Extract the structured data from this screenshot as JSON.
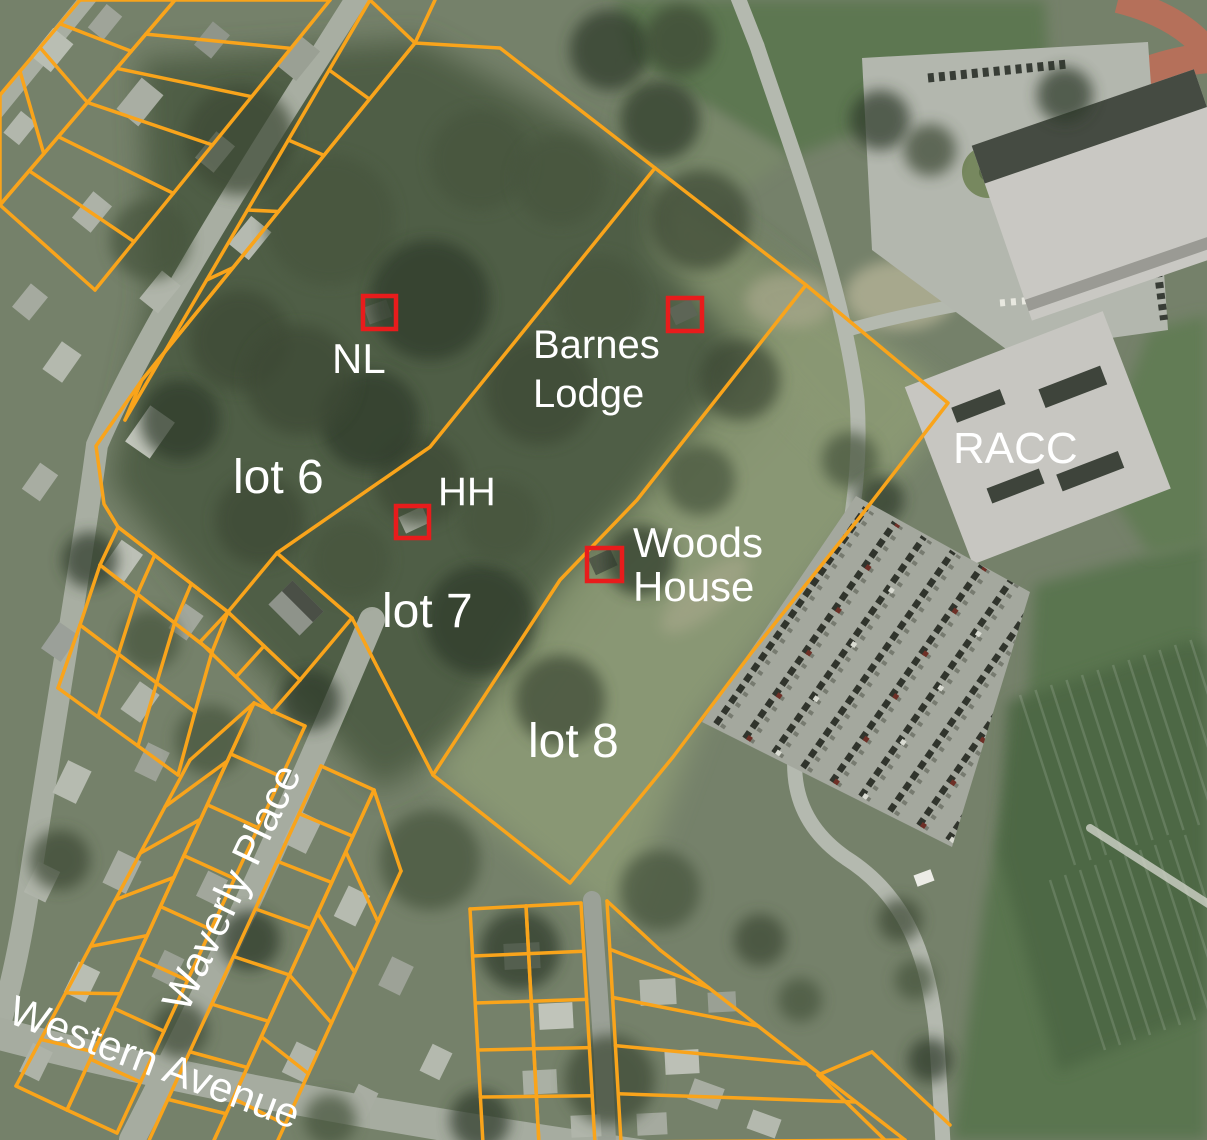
{
  "map": {
    "type": "aerial-parcel-map",
    "labels": {
      "nl": "NL",
      "barnes_line1": "Barnes",
      "barnes_line2": "Lodge",
      "lot6": "lot 6",
      "hh": "HH",
      "lot7": "lot 7",
      "woods_line1": "Woods",
      "woods_line2": "House",
      "racc": "RACC",
      "lot8": "lot 8"
    },
    "streets": {
      "waverly": "Waverly Place",
      "western": "Western Avenue"
    },
    "markers": [
      {
        "id": "nl",
        "label": "NL"
      },
      {
        "id": "barnes-lodge",
        "label": "Barnes Lodge"
      },
      {
        "id": "hh",
        "label": "HH"
      },
      {
        "id": "woods-house",
        "label": "Woods House"
      }
    ],
    "lots": [
      "lot 6",
      "lot 7",
      "lot 8"
    ],
    "colors": {
      "parcel_line": "#F9A41B",
      "building_marker": "#E81C1C",
      "label_text": "#FFFFFF"
    }
  }
}
